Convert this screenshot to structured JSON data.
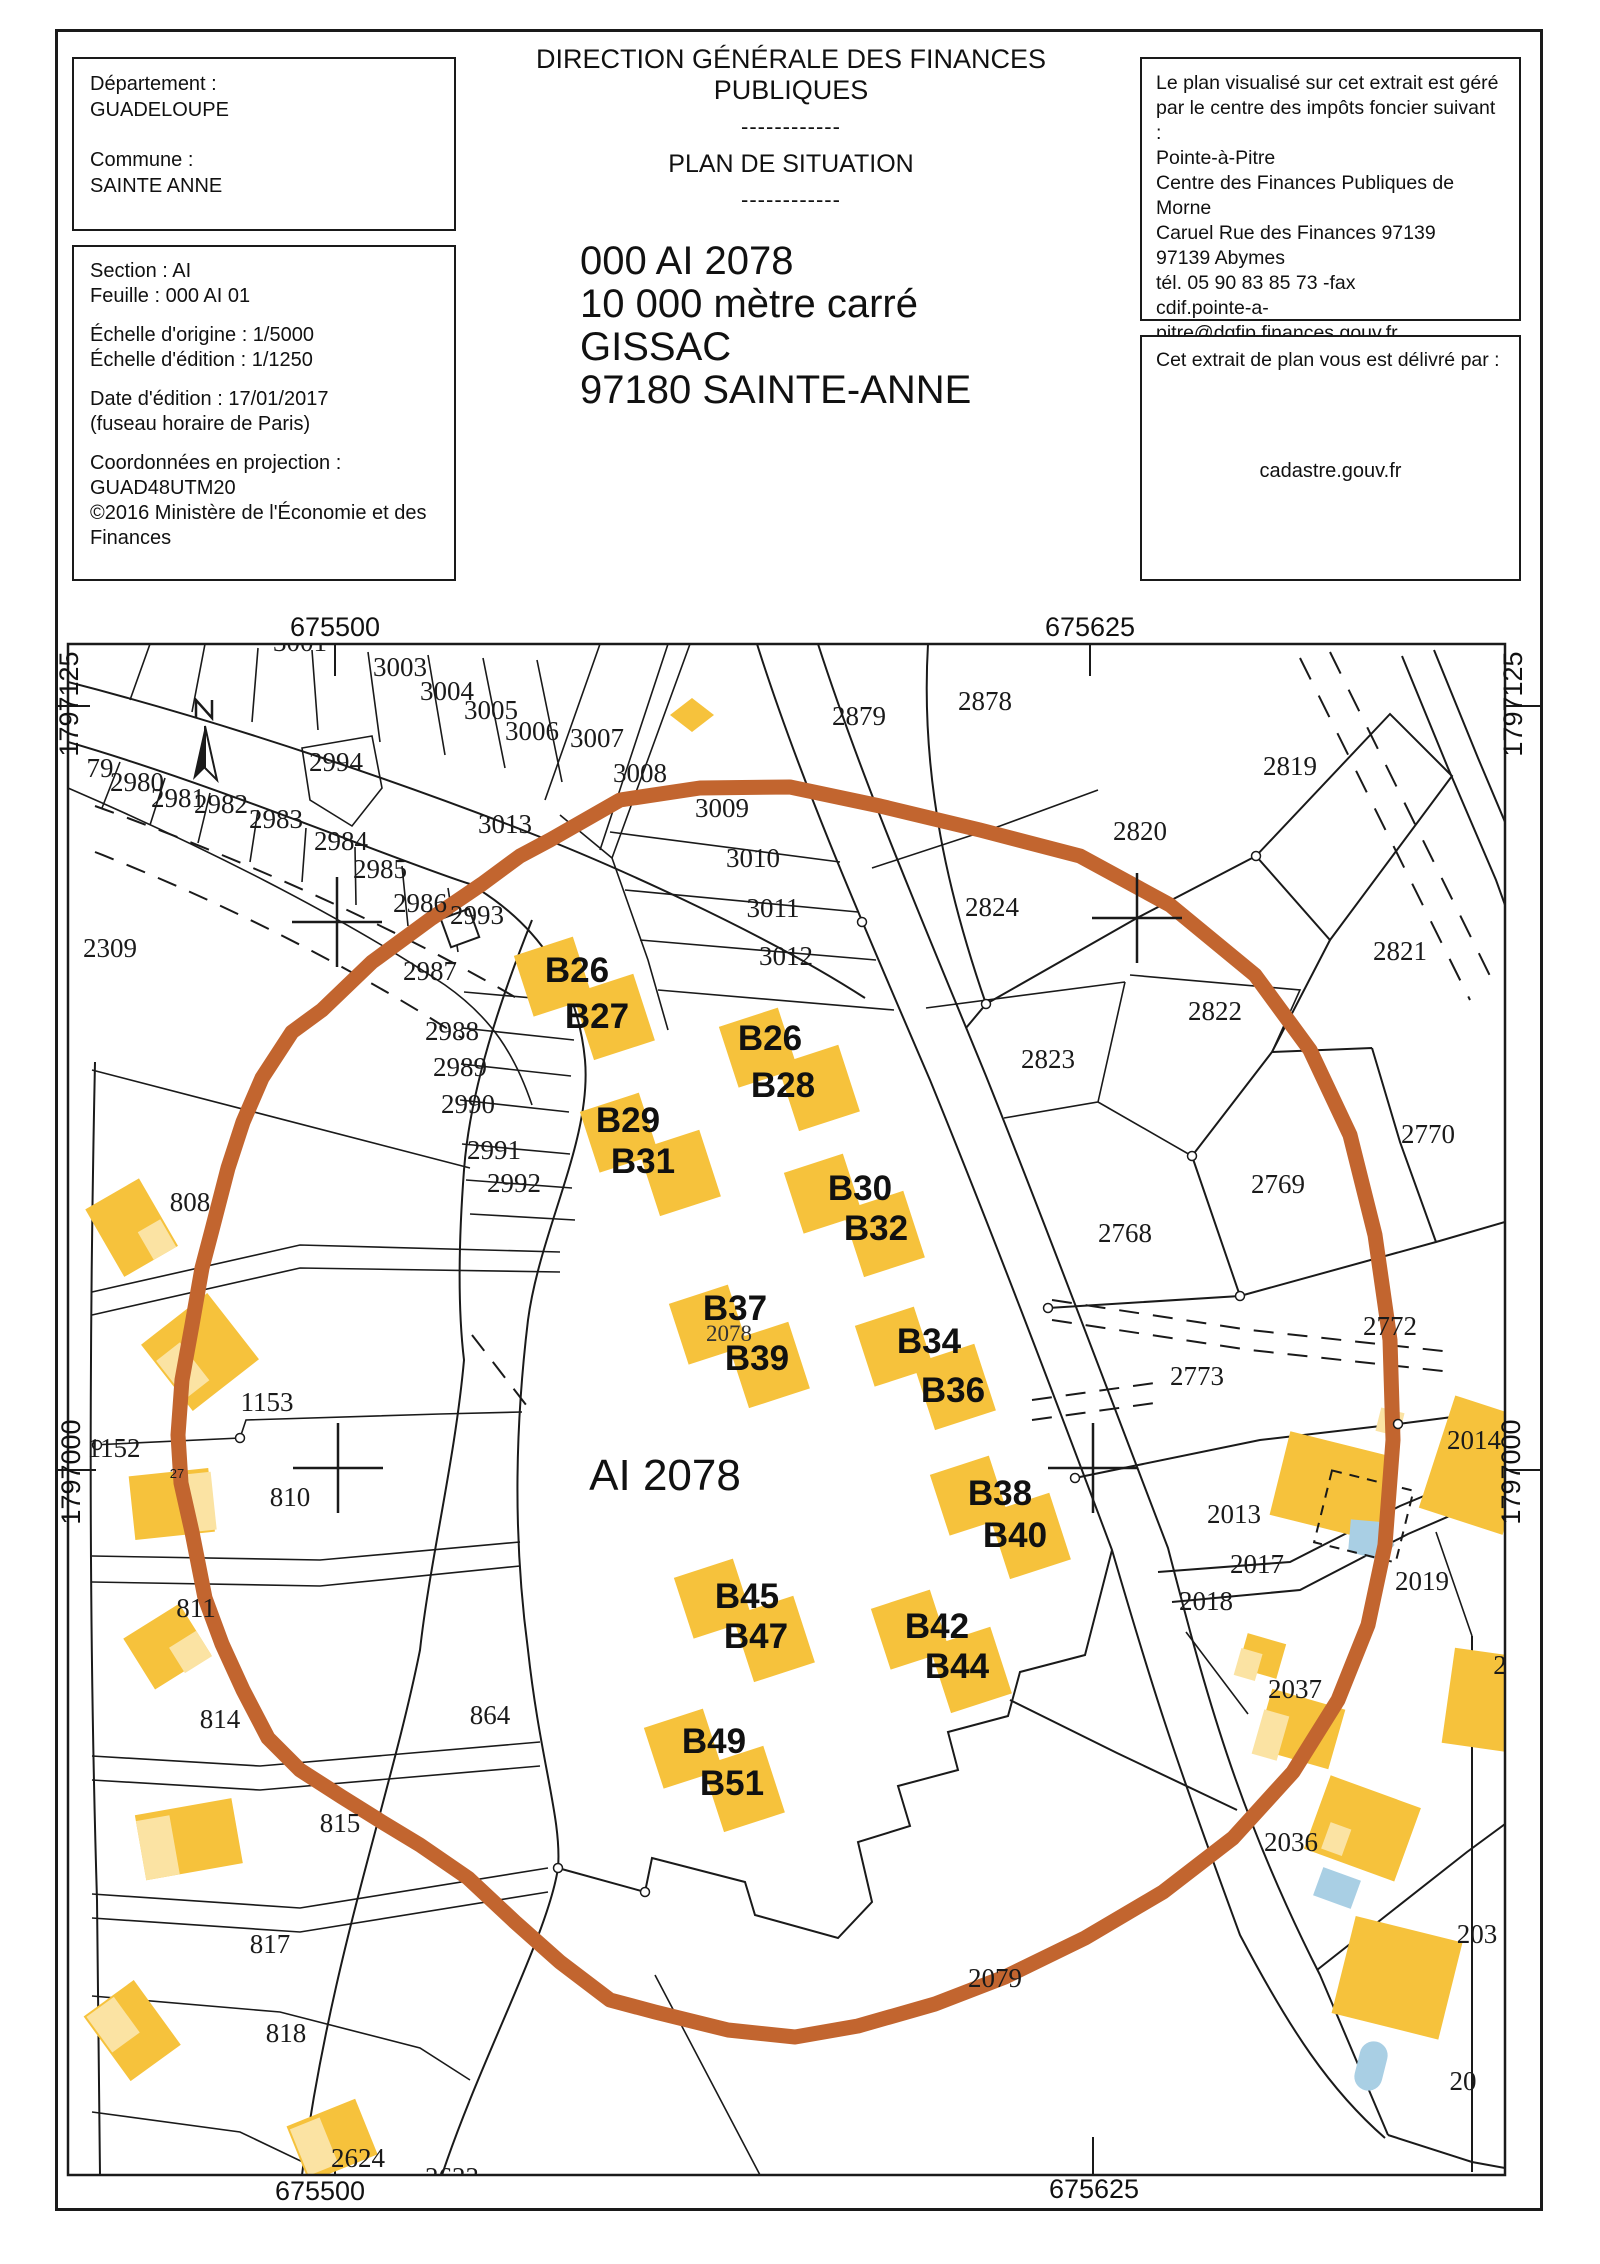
{
  "header": {
    "dept_box": {
      "l1": "Département :",
      "l2": "GUADELOUPE",
      "l3": "Commune :",
      "l4": "SAINTE ANNE"
    },
    "meta_box": {
      "l1": "Section : AI",
      "l2": "Feuille : 000 AI 01",
      "l3": "Échelle d'origine : 1/5000",
      "l4": "Échelle d'édition : 1/1250",
      "l5": "Date d'édition : 17/01/2017",
      "l6": "(fuseau horaire de Paris)",
      "l7": "Coordonnées en projection :",
      "l8": "GUAD48UTM20",
      "l9": "©2016 Ministère de l'Économie et des",
      "l10": "Finances"
    },
    "title": "DIRECTION GÉNÉRALE DES FINANCES PUBLIQUES",
    "separator": "------------",
    "subtitle": "PLAN DE SITUATION",
    "parcel_id": "000 AI 2078",
    "area": "10 000 mètre carré",
    "place": "GISSAC",
    "city": "97180 SAINTE-ANNE",
    "cdif_box": {
      "l1": "Le plan visualisé sur cet extrait est géré",
      "l2": "par le centre des impôts foncier suivant :",
      "l3": "Pointe-à-Pitre",
      "l4": "Centre des Finances Publiques de Morne",
      "l5": "Caruel Rue des Finances 97139",
      "l6": "97139 Abymes",
      "l7": "tél. 05 90 83 85 73 -fax",
      "l8": "cdif.pointe-a-pitre@dgfip.finances.gouv.fr"
    },
    "deliv_box": {
      "l1": "Cet extrait de plan vous est délivré par :",
      "l2": "cadastre.gouv.fr"
    }
  },
  "map": {
    "coordinates": {
      "top_left": "675500",
      "top_right": "675625",
      "bottom_left": "675500",
      "bottom_right": "675625",
      "left_top": "1797125",
      "left_bottom": "1797000",
      "right_top": "1797125",
      "right_bottom": "1797000"
    },
    "main_parcel_label": "AI 2078",
    "colors": {
      "highlight_ring": "#C2652F",
      "building": "#F6C23C",
      "building_light": "#FBE3A3",
      "pool": "#A9CFE4",
      "line": "#1a1a1a",
      "label": "#1a1a1a"
    },
    "parcel_labels": [
      {
        "t": "3001",
        "x": 300,
        "y": 651
      },
      {
        "t": "3003",
        "x": 400,
        "y": 676
      },
      {
        "t": "3004",
        "x": 447,
        "y": 700
      },
      {
        "t": "3005",
        "x": 491,
        "y": 719
      },
      {
        "t": "3006",
        "x": 532,
        "y": 740
      },
      {
        "t": "3007",
        "x": 597,
        "y": 747
      },
      {
        "t": "3008",
        "x": 640,
        "y": 782
      },
      {
        "t": "3009",
        "x": 722,
        "y": 817
      },
      {
        "t": "3010",
        "x": 753,
        "y": 867
      },
      {
        "t": "3011",
        "x": 773,
        "y": 917
      },
      {
        "t": "3012",
        "x": 786,
        "y": 965
      },
      {
        "t": "3013",
        "x": 505,
        "y": 833
      },
      {
        "t": "2994",
        "x": 336,
        "y": 771
      },
      {
        "t": "79",
        "x": 100,
        "y": 777
      },
      {
        "t": "2980",
        "x": 137,
        "y": 791
      },
      {
        "t": "2981",
        "x": 178,
        "y": 807
      },
      {
        "t": "2982",
        "x": 221,
        "y": 813
      },
      {
        "t": "2983",
        "x": 276,
        "y": 828
      },
      {
        "t": "2984",
        "x": 341,
        "y": 850
      },
      {
        "t": "2985",
        "x": 380,
        "y": 878
      },
      {
        "t": "2986",
        "x": 420,
        "y": 912
      },
      {
        "t": "2993",
        "x": 477,
        "y": 924
      },
      {
        "t": "2987",
        "x": 430,
        "y": 980
      },
      {
        "t": "2309",
        "x": 110,
        "y": 957
      },
      {
        "t": "2988",
        "x": 452,
        "y": 1040
      },
      {
        "t": "2989",
        "x": 460,
        "y": 1076
      },
      {
        "t": "2990",
        "x": 468,
        "y": 1113
      },
      {
        "t": "2991",
        "x": 494,
        "y": 1159
      },
      {
        "t": "2992",
        "x": 514,
        "y": 1192
      },
      {
        "t": "2879",
        "x": 859,
        "y": 725
      },
      {
        "t": "2878",
        "x": 985,
        "y": 710
      },
      {
        "t": "2819",
        "x": 1290,
        "y": 775
      },
      {
        "t": "2820",
        "x": 1140,
        "y": 840
      },
      {
        "t": "2821",
        "x": 1400,
        "y": 960
      },
      {
        "t": "2822",
        "x": 1215,
        "y": 1020
      },
      {
        "t": "2823",
        "x": 1048,
        "y": 1068
      },
      {
        "t": "2824",
        "x": 992,
        "y": 916
      },
      {
        "t": "2768",
        "x": 1125,
        "y": 1242
      },
      {
        "t": "2769",
        "x": 1278,
        "y": 1193
      },
      {
        "t": "2770",
        "x": 1428,
        "y": 1143
      },
      {
        "t": "2772",
        "x": 1390,
        "y": 1335
      },
      {
        "t": "2773",
        "x": 1197,
        "y": 1385
      },
      {
        "t": "2014",
        "x": 1474,
        "y": 1449
      },
      {
        "t": "2013",
        "x": 1234,
        "y": 1523
      },
      {
        "t": "2017",
        "x": 1257,
        "y": 1573
      },
      {
        "t": "2018",
        "x": 1206,
        "y": 1610
      },
      {
        "t": "2019",
        "x": 1422,
        "y": 1590
      },
      {
        "t": "2037",
        "x": 1295,
        "y": 1698
      },
      {
        "t": "2036",
        "x": 1291,
        "y": 1851
      },
      {
        "t": "2079",
        "x": 995,
        "y": 1987
      },
      {
        "t": "808",
        "x": 190,
        "y": 1211
      },
      {
        "t": "1153",
        "x": 267,
        "y": 1411
      },
      {
        "t": "1152",
        "x": 114,
        "y": 1457
      },
      {
        "t": "810",
        "x": 290,
        "y": 1506
      },
      {
        "t": "811",
        "x": 196,
        "y": 1617
      },
      {
        "t": "814",
        "x": 220,
        "y": 1728
      },
      {
        "t": "815",
        "x": 340,
        "y": 1832
      },
      {
        "t": "817",
        "x": 270,
        "y": 1953
      },
      {
        "t": "818",
        "x": 286,
        "y": 2042
      },
      {
        "t": "864",
        "x": 490,
        "y": 1724
      },
      {
        "t": "2624",
        "x": 358,
        "y": 2167
      },
      {
        "t": "2623",
        "x": 452,
        "y": 2186
      },
      {
        "t": "203",
        "x": 1477,
        "y": 1943
      },
      {
        "t": "20",
        "x": 1463,
        "y": 2090
      },
      {
        "t": "2",
        "x": 1500,
        "y": 1674
      },
      {
        "t": "2078",
        "x": 729,
        "y": 1341,
        "s": "sm"
      },
      {
        "t": "27",
        "x": 177,
        "y": 1478,
        "s": "xs"
      }
    ],
    "building_labels": [
      {
        "t": "B26",
        "x": 577,
        "y": 982
      },
      {
        "t": "B27",
        "x": 597,
        "y": 1028
      },
      {
        "t": "B26",
        "x": 770,
        "y": 1050
      },
      {
        "t": "B28",
        "x": 783,
        "y": 1097
      },
      {
        "t": "B29",
        "x": 628,
        "y": 1132
      },
      {
        "t": "B31",
        "x": 643,
        "y": 1173
      },
      {
        "t": "B30",
        "x": 860,
        "y": 1200
      },
      {
        "t": "B32",
        "x": 876,
        "y": 1240
      },
      {
        "t": "B37",
        "x": 735,
        "y": 1320
      },
      {
        "t": "B39",
        "x": 757,
        "y": 1370
      },
      {
        "t": "B34",
        "x": 929,
        "y": 1353
      },
      {
        "t": "B36",
        "x": 953,
        "y": 1402
      },
      {
        "t": "B38",
        "x": 1000,
        "y": 1505
      },
      {
        "t": "B40",
        "x": 1015,
        "y": 1547
      },
      {
        "t": "B45",
        "x": 747,
        "y": 1608
      },
      {
        "t": "B47",
        "x": 756,
        "y": 1648
      },
      {
        "t": "B42",
        "x": 937,
        "y": 1638
      },
      {
        "t": "B44",
        "x": 957,
        "y": 1678
      },
      {
        "t": "B49",
        "x": 714,
        "y": 1753
      },
      {
        "t": "B51",
        "x": 732,
        "y": 1795
      }
    ]
  }
}
